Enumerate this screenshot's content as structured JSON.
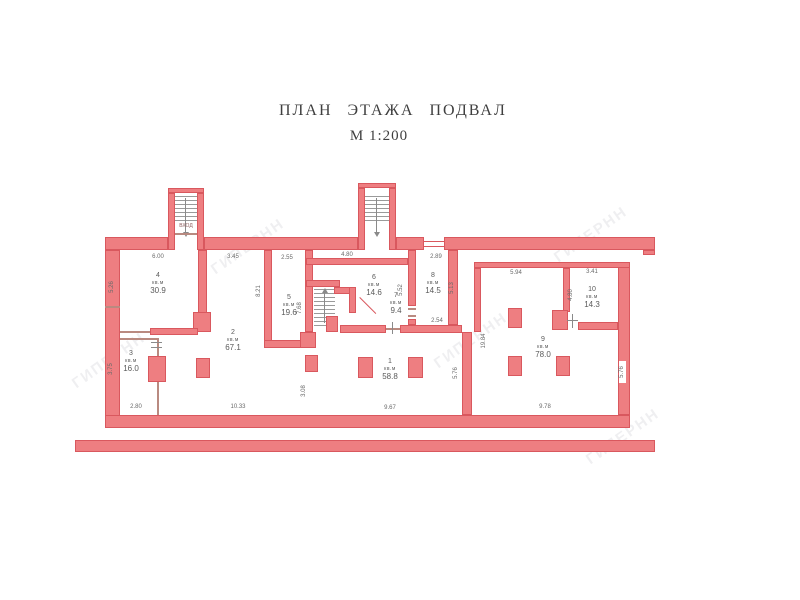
{
  "title": {
    "line1": "ПЛАН ЭТАЖА ПОДВАЛ",
    "line2": "М 1:200"
  },
  "entrance_label": "ВХОД",
  "unit_label": "кв.м",
  "watermark": {
    "text": "ГИПЕРНН"
  },
  "colors": {
    "wall_fill": "#ee7e81",
    "wall_outline": "#d9585e",
    "label_text": "#5a5a5a",
    "title_text": "#3f3f3f"
  },
  "rooms": [
    {
      "number": "1",
      "area": "58.8"
    },
    {
      "number": "2",
      "area": "67.1"
    },
    {
      "number": "3",
      "area": "16.0"
    },
    {
      "number": "4",
      "area": "30.9"
    },
    {
      "number": "5",
      "area": "19.6"
    },
    {
      "number": "6",
      "area": "14.6"
    },
    {
      "number": "7",
      "area": "9.4"
    },
    {
      "number": "8",
      "area": "14.5"
    },
    {
      "number": "9",
      "area": "78.0"
    },
    {
      "number": "10",
      "area": "14.3"
    }
  ],
  "dimensions": {
    "top_room4": "6.00",
    "top_room2": "3.45",
    "top_room5": "2.55",
    "top_room6": "4.80",
    "top_room8": "2.89",
    "top_room9": "5.94",
    "top_room10": "3.41",
    "bottom_room3": "2.80",
    "bottom_room2": "10.33",
    "bottom_room1": "9.67",
    "bottom_room9": "9.78",
    "room8_bottom": "2.54",
    "v_room4_left": "5.26",
    "v_room3_left": "3.75",
    "v_room2": "8.21",
    "v_room5": "7.68",
    "v_room1_left": "3.08",
    "v_room8_left": "5.52",
    "v_room8_right": "5.13",
    "v_room1_right": "5.76",
    "v_room9_left": "19.84",
    "v_room10_left": "4.80",
    "v_room9_right": "5.76"
  }
}
